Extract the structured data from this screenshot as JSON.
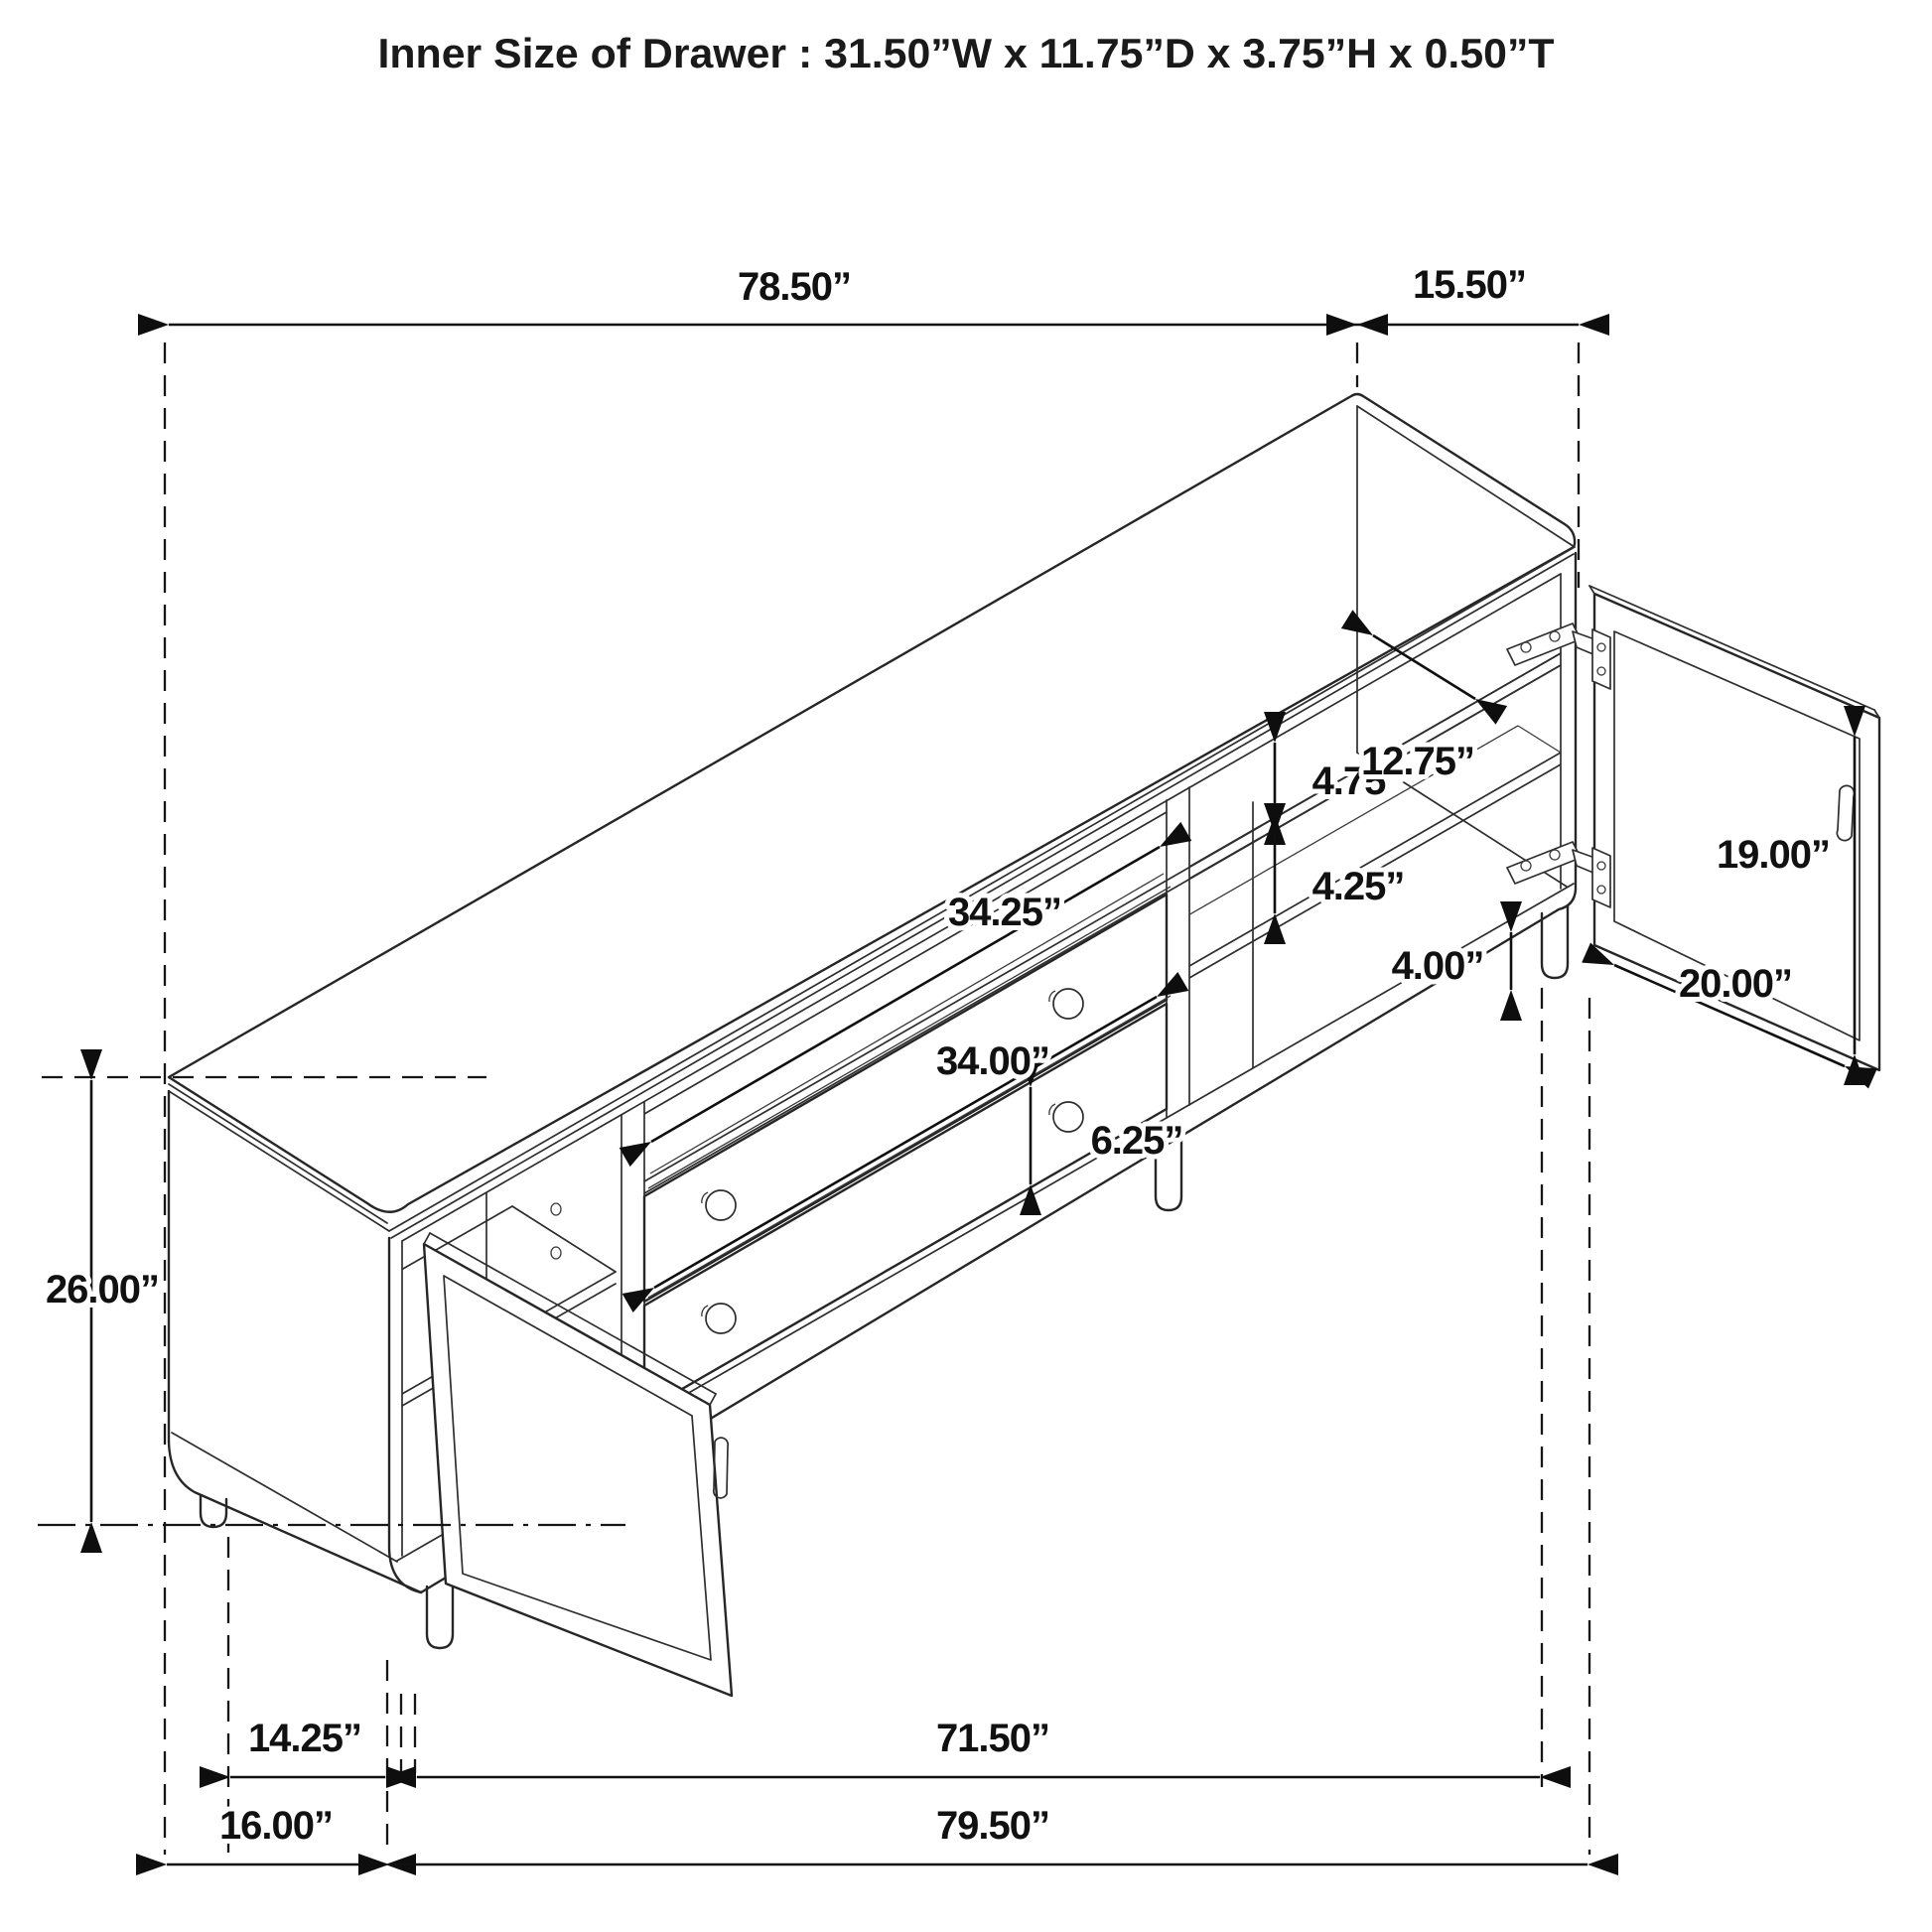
{
  "title": "Inner Size of Drawer : 31.50”W x 11.75”D x 3.75”H x 0.50”T",
  "drawing": {
    "kind": "isometric furniture dimension diagram",
    "subject": "accent TV console with cane mesh door, two drawers and glass door",
    "colors": {
      "background": "#ffffff",
      "line": "#262626",
      "text": "#111111"
    }
  },
  "labels": {
    "overall_width": "78.50”",
    "depth": "15.50”",
    "overall_height": "26.00”",
    "left_leg_span": "14.25”",
    "left_section_width": "16.00”",
    "floor_span_inner": "71.50”",
    "floor_span_outer": "79.50”",
    "media_opening_width": "34.25”",
    "drawer_width": "34.00”",
    "drawer_front_height": "6.25”",
    "upper_opening_height": "4.75”",
    "shelf_depth": "12.75”",
    "lower_opening_height": "4.25”",
    "leg_height": "4.00”",
    "door_height": "19.00”",
    "door_width": "20.00”"
  }
}
